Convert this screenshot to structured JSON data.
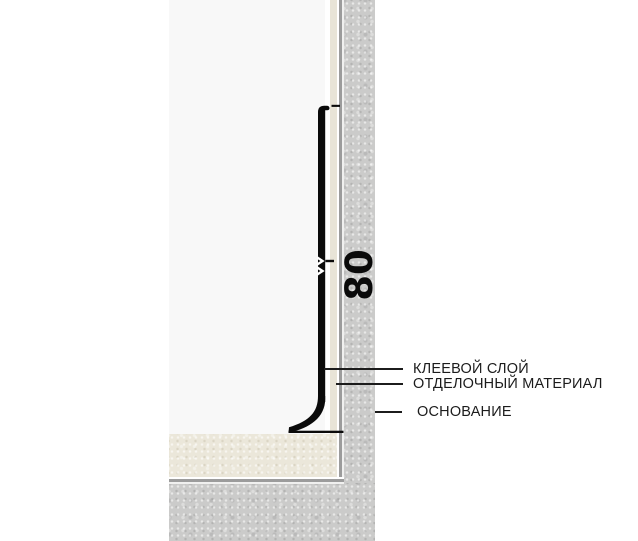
{
  "diagram": {
    "dimension_label": "80",
    "labels": [
      {
        "id": "adhesive-layer",
        "text": "КЛЕЕВОЙ СЛОЙ"
      },
      {
        "id": "finishing-material",
        "text": "ОТДЕЛОЧНЫЙ МАТЕРИАЛ"
      },
      {
        "id": "substrate",
        "text": "ОСНОВАНИЕ"
      }
    ],
    "colors": {
      "background": "#ffffff",
      "profile_black": "#0a0a0a",
      "wall_panel": "#f8f8f8",
      "wall_finishing_strip": "#e8e4d7",
      "floor_finishing": "#ebe7da",
      "substrate_concrete": "#cbcbca",
      "border_line_gray": "#9c9c9c",
      "leader_line": "#1c1c1c",
      "text": "#1c1c1c"
    }
  }
}
